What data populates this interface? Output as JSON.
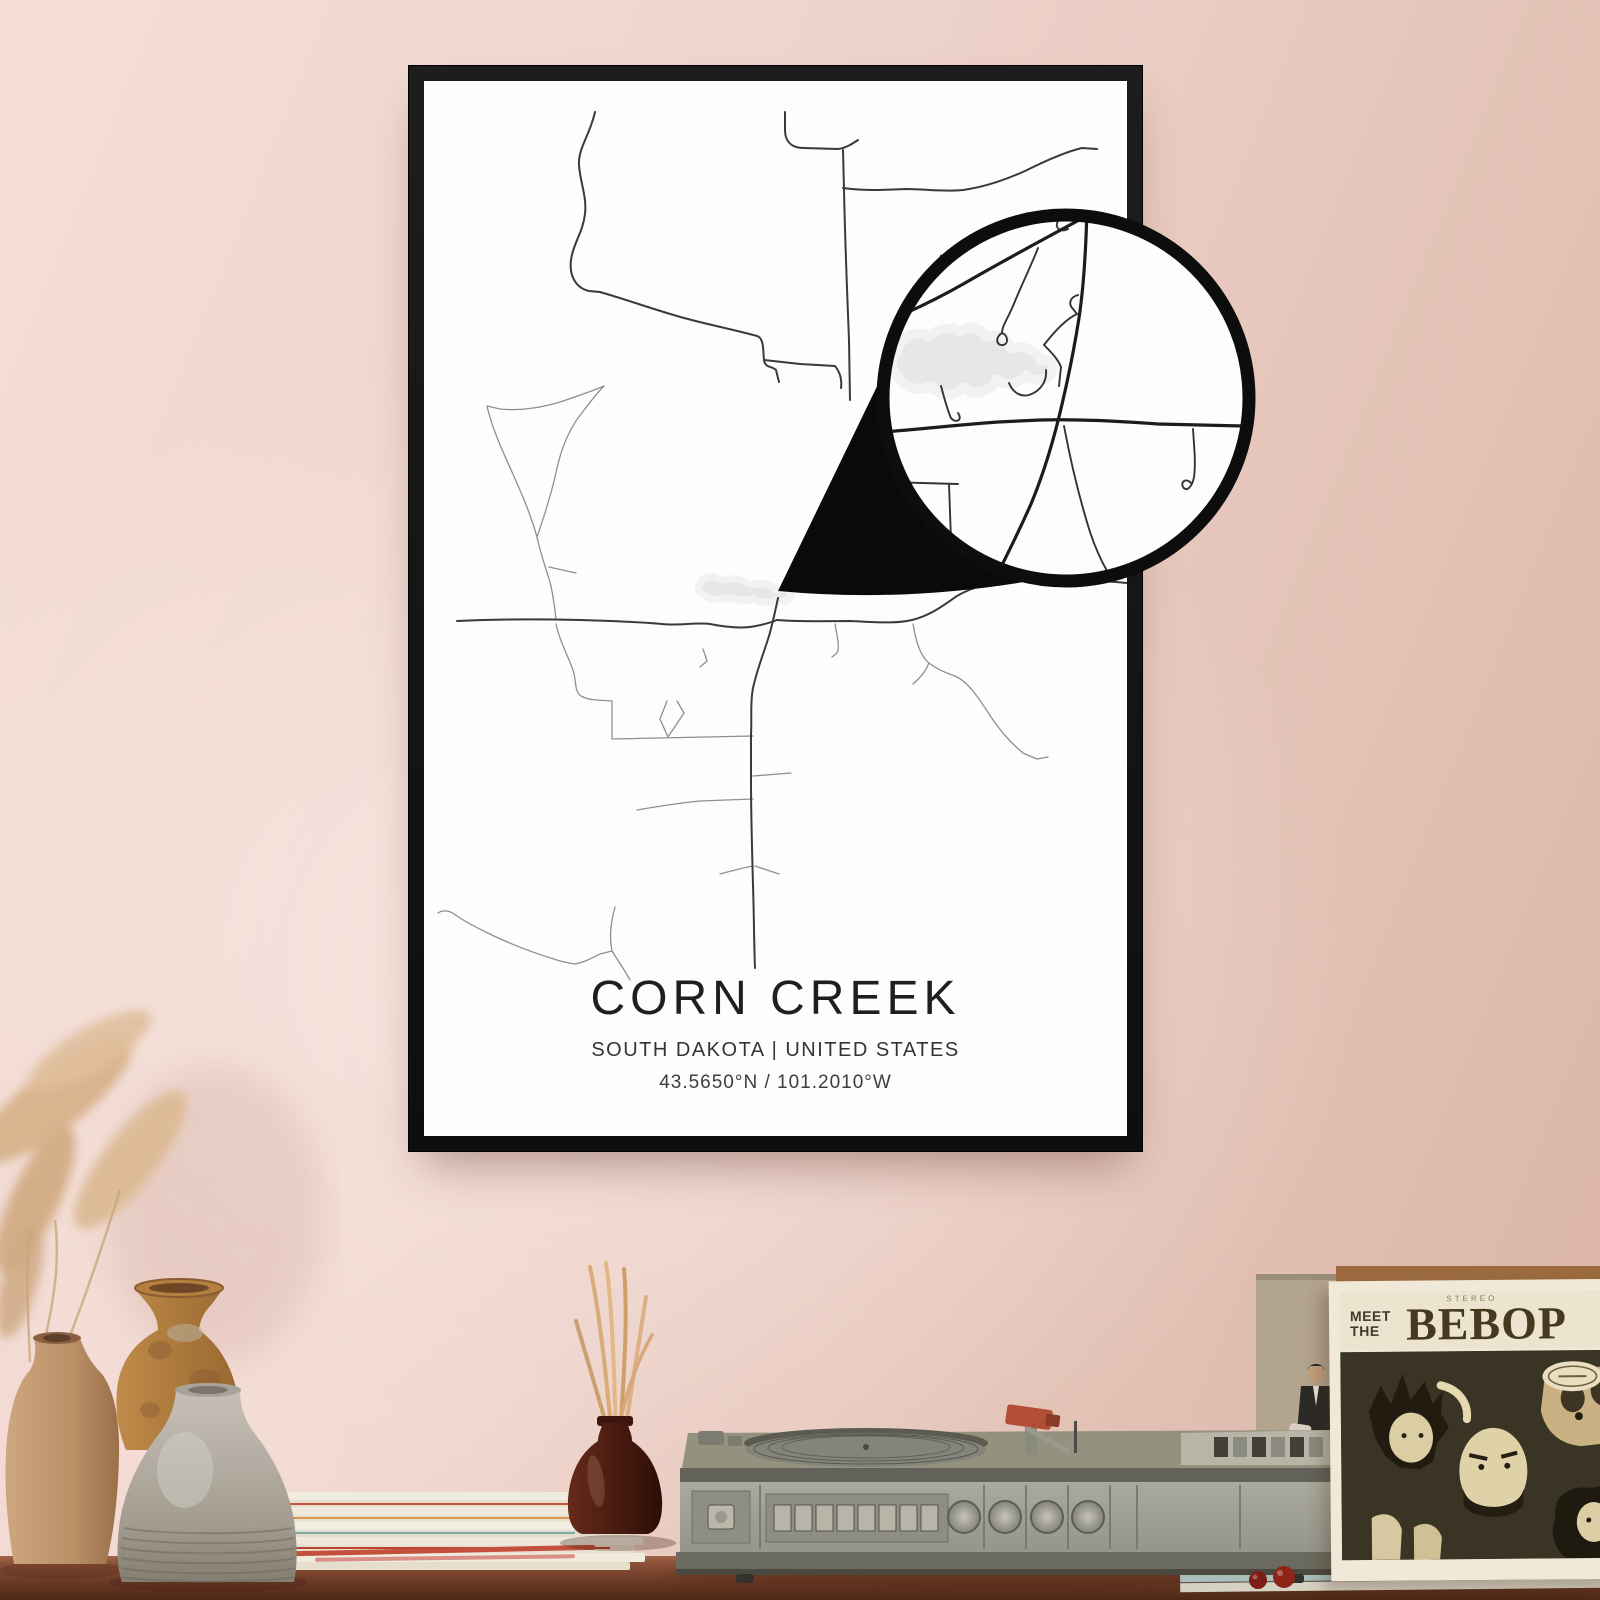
{
  "poster": {
    "title": "CORN CREEK",
    "subtitle": "SOUTH DAKOTA | UNITED STATES",
    "coordinates": "43.5650°N / 101.2010°W",
    "water": "M699,586 C701,578 711,574 719,579 C725,582 731,577 738,579 C745,581 748,586 756,584 C763,582 772,585 777,591 C783,587 790,590 792,595 C790,601 782,603 776,600 C769,604 761,602 753,599 C745,602 736,599 728,598 C719,601 709,599 704,595 C699,592 697,590 699,586 Z",
    "roads_major": [
      "M457,621 C500,619 540,619 580,620 C615,621 640,622 662,624 C680,626 695,622 710,624 C725,627 742,629 756,626 C766,624 772,622 777,620",
      "M777,620 C800,622 825,621 850,621 C875,622 895,624 912,620 C932,615 945,604 957,596 C975,585 1000,580 1030,579 C1060,578 1095,580 1127,583",
      "M843,150 L844,190 C845,240 847,290 849,340 L850,400",
      "M778,598 C775,612 773,622 769,636 C763,655 757,670 753,688 C750,703 752,718 751,734 L751,780 C751,815 752,850 753,885 C754,915 754,945 755,968",
      "M595,112 C590,135 578,148 579,165 C580,182 587,196 585,214 C583,232 573,244 571,260 C569,276 576,288 589,291 L600,292",
      "M600,292 C628,300 655,310 684,318 C710,325 735,330 757,336 C764,338 763,350 764,360 C765,368 772,366 776,370 L779,382",
      "M764,360 L800,364 835,366 M835,366 C840,372 842,380 841,388",
      "M785,112 L785,130 C785,142 792,148 804,148 L838,149 M838,149 C846,148 852,144 858,140",
      "M843,188 C865,191 885,190 905,189 C925,189 945,192 963,190 C985,187 1005,180 1025,171 C1045,161 1065,152 1082,148 L1097,149"
    ],
    "roads_minor": [
      "M604,386 C590,392 575,397 560,402 C540,408 520,411 500,409 L487,406 C492,428 502,450 512,472 C520,490 528,508 534,527 L537,537 C545,514 552,492 557,468 C562,446 570,428 581,414 C588,405 596,394 604,386",
      "M537,537 C541,556 547,571 551,586 C553,596 555,608 556,620 M549,567 L576,573",
      "M556,624 C560,642 568,656 573,670 C577,683 574,691 581,696 C590,701 602,700 612,701",
      "M612,701 L612,739 M612,739 L753,736 M668,737 L684,713 677,701 M667,701 L660,719 668,737",
      "M753,776 L791,773 M637,810 C660,806 680,803 700,801 L753,799 M720,874 C731,871 742,868 753,866 M755,866 L779,874",
      "M438,913 C444,909 451,911 457,916 C470,925 482,930 494,936 C515,946 537,954 560,961 L574,964 C583,963 592,958 600,954 L612,951 M615,907 C611,922 609,936 612,951 M612,951 C619,962 625,971 630,980",
      "M913,624 C916,641 920,656 929,663 C939,671 948,673 957,677 C969,683 980,700 991,717 C1001,732 1012,744 1023,753 M1023,753 L1037,759 1048,757 M929,663 C925,673 919,679 913,684 M835,624 C837,636 840,646 837,653 L832,657",
      "M703,649 L707,661 700,667"
    ]
  },
  "callout": {
    "water": "M897,352 C900,337 916,329 929,336 C938,329 951,325 959,332 C968,324 981,328 986,337 C996,332 1009,338 1011,349 C1023,344 1036,350 1041,361 C1049,357 1055,365 1051,373 C1045,383 1032,381 1026,375 C1018,385 1004,387 997,379 C990,393 974,397 964,387 C954,398 939,396 931,386 C919,392 904,388 899,377 C891,371 889,361 897,352 Z",
    "roads_major": [
      "M1087,208 C1086,248 1084,285 1079,318 C1074,350 1069,374 1063,400 C1056,431 1046,468 1031,504 C1019,531 1009,551 1001,567",
      "M884,432 C920,429 958,425 998,422 L1040,420 C1078,419 1118,421 1158,424 L1244,426",
      "M1081,219 C1042,240 1003,261 965,283 C944,295 924,305 906,313"
    ],
    "roads_minor": [
      "M1081,219 C1074,212 1063,214 1058,221 C1054,228 1061,233 1068,229",
      "M1038,248 C1031,266 1021,286 1013,306 C1008,318 1002,326 1002,333 M1002,333 C995,337 996,346 1003,345 C1009,344 1008,335 1002,333",
      "M1078,295 C1070,297 1068,304 1073,309 L1077,314 C1066,319 1054,332 1044,345 M1044,345 C1051,352 1058,359 1061,367 L1059,386",
      "M941,386 C945,401 948,412 951,418 C956,424 963,420 958,413 M1009,383 C1013,393 1021,397 1029,395 C1041,391 1047,381 1046,370",
      "M886,482 L958,484 M949,484 L951,540 M917,560 L955,587",
      "M1064,426 C1070,458 1079,497 1090,532 C1096,550 1102,562 1107,571",
      "M1193,429 C1194,446 1196,462 1194,477 C1192,488 1186,492 1183,487 C1180,481 1187,478 1191,483"
    ]
  },
  "album": {
    "stereo_label": "STEREO",
    "title_word_1": "MEET",
    "title_word_2": "THE",
    "title_main": "BEBOP"
  },
  "colors": {
    "wall_a": "#f3ddd6",
    "wall_b": "#eed4cc",
    "wall_c": "#e4c2b6",
    "wall_d": "#d9b3a6",
    "frame": "#161616",
    "paper": "#fdfdfc",
    "road": "#3a3a3a",
    "road_minor": "#8f8f8f",
    "water": "#e7e7e7",
    "water_halo": "#f2f2f2",
    "ring": "#0d0d0d",
    "fold": "#0a0a0a",
    "zroad": "#1c1c1c",
    "zroad_minor": "#333333",
    "table_top": "#8a5138",
    "table_mid": "#6d3b26",
    "table_dark": "#4e2817",
    "album_border": "#f1e9d7",
    "album_band": "#ece4cf",
    "album_art": "#3a3424",
    "back_album": "#b3a48d",
    "wood_strip": "#9b6b3f",
    "bottle": "#4a1c10",
    "reed": "#d7a977",
    "pampas": "#d9b48f",
    "berry": "#8e2319"
  }
}
